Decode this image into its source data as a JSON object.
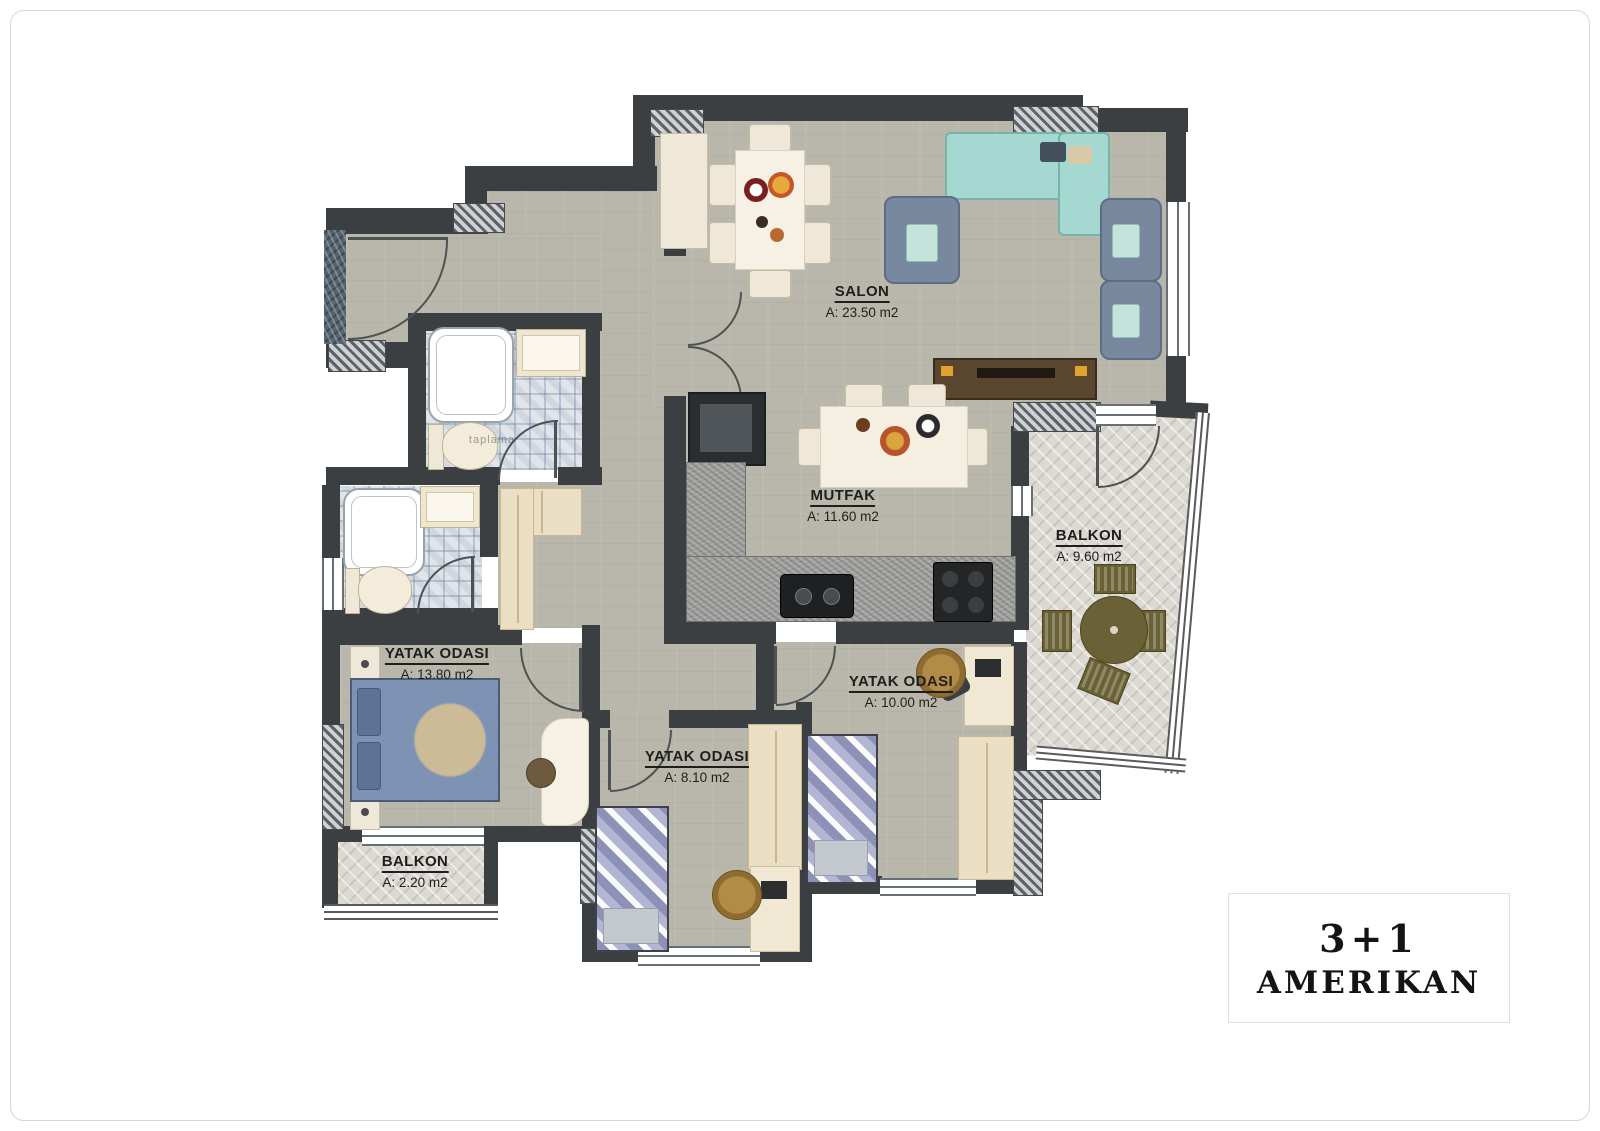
{
  "plan": {
    "rooms": [
      {
        "key": "salon",
        "name": "SALON",
        "area": "A: 23.50 m2"
      },
      {
        "key": "mutfak",
        "name": "MUTFAK",
        "area": "A: 11.60 m2"
      },
      {
        "key": "balkon-large",
        "name": "BALKON",
        "area": "A: 9.60 m2"
      },
      {
        "key": "yatak-odasi-1",
        "name": "YATAK ODASI",
        "area": "A: 13.80 m2"
      },
      {
        "key": "yatak-odasi-2",
        "name": "YATAK ODASI",
        "area": "A: 10.00 m2"
      },
      {
        "key": "yatak-odasi-3",
        "name": "YATAK ODASI",
        "area": "A: 8.10 m2"
      },
      {
        "key": "balkon-small",
        "name": "BALKON",
        "area": "A: 2.20 m2"
      }
    ],
    "watermark": "taplama"
  },
  "title_box": {
    "line1": "3+1",
    "line2": "AMERIKAN"
  },
  "colors": {
    "wall": "#3b3f42",
    "floor": "#b9b7ab",
    "balcony_floor": "#dcd8d2",
    "tile_blue": "#5674a0",
    "sofa_teal": "#a5d8d0",
    "armchair_blue": "#78889f",
    "bed_blue": "#7e93b4"
  }
}
